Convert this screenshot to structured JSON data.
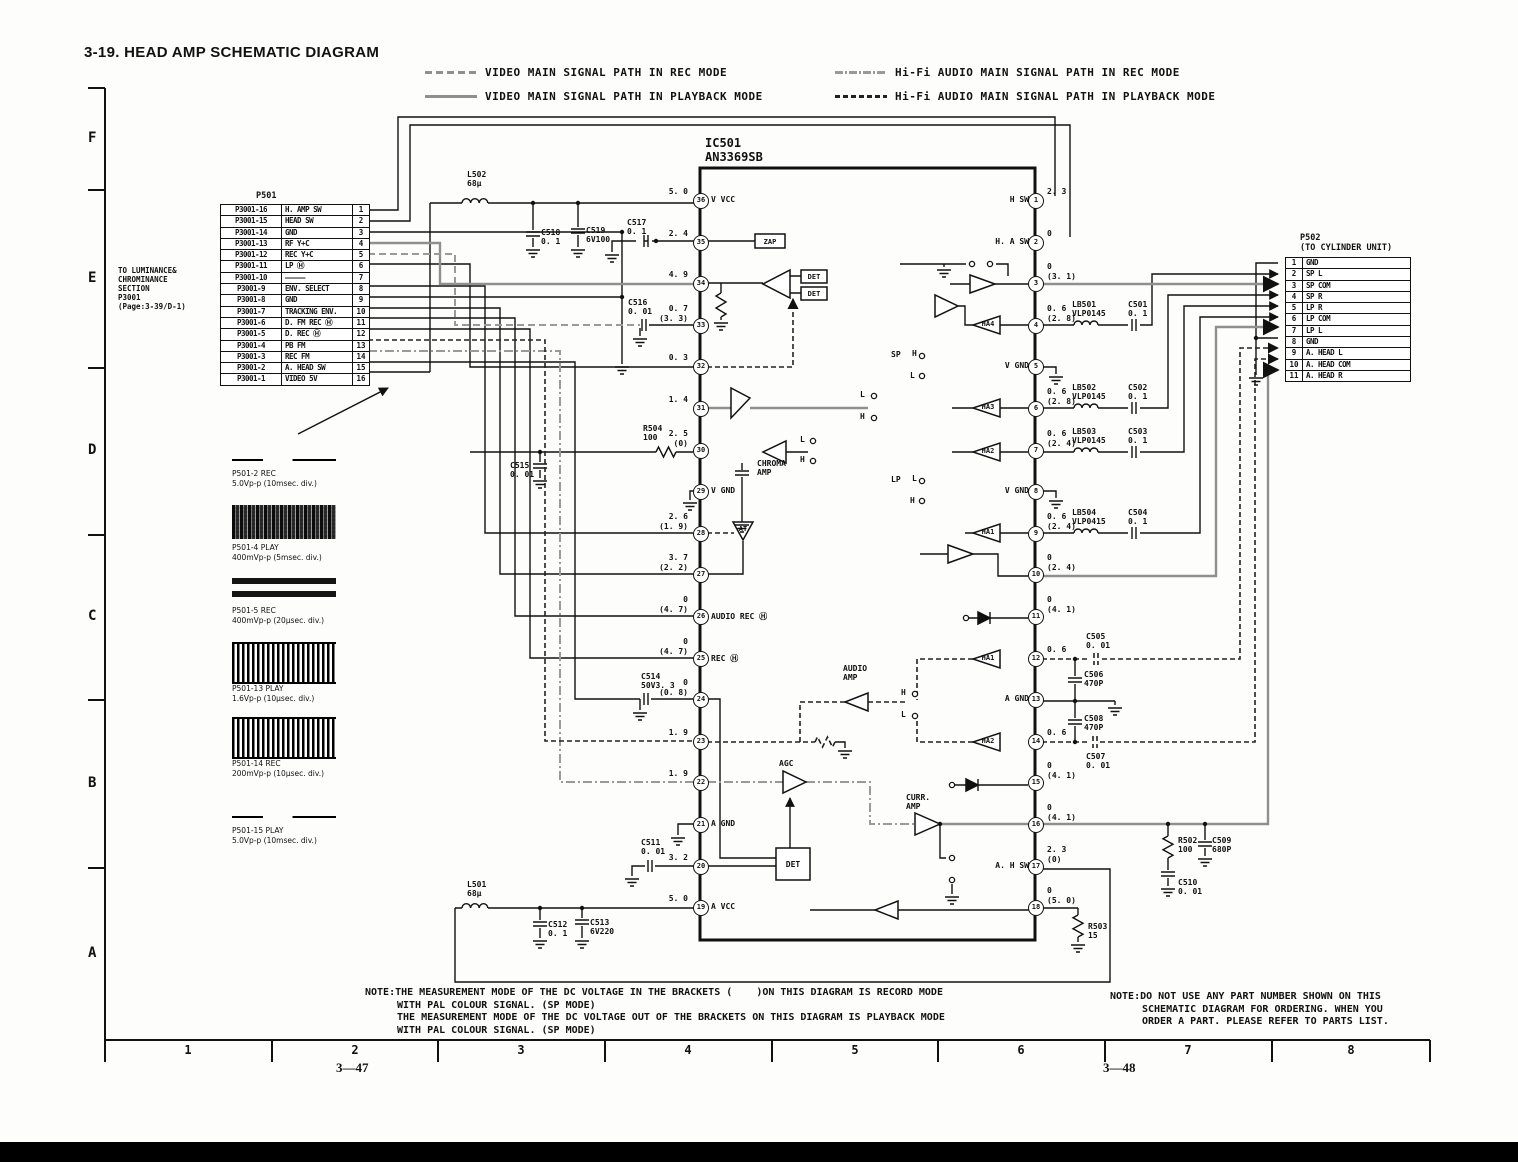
{
  "page": {
    "title": "3-19.  HEAD AMP SCHEMATIC DIAGRAM",
    "page_left": "3—47",
    "page_right": "3—48"
  },
  "colors": {
    "ink": "#111111",
    "gray_path": "#8f8f8f",
    "background": "#fdfdfb"
  },
  "legend": [
    {
      "label": "VIDEO MAIN SIGNAL PATH IN REC MODE",
      "style": "video-rec"
    },
    {
      "label": "VIDEO MAIN SIGNAL PATH IN PLAYBACK MODE",
      "style": "video-play"
    },
    {
      "label": "Hi-Fi AUDIO MAIN SIGNAL PATH IN REC MODE",
      "style": "hifi-rec"
    },
    {
      "label": "Hi-Fi AUDIO MAIN SIGNAL PATH IN PLAYBACK MODE",
      "style": "hifi-play"
    }
  ],
  "grid": {
    "rows": [
      "F",
      "E",
      "D",
      "C",
      "B",
      "A"
    ],
    "cols": [
      "1",
      "2",
      "3",
      "4",
      "5",
      "6",
      "7",
      "8"
    ]
  },
  "p501": {
    "title": "P501",
    "note": "TO LUMINANCE&\nCHROMINANCE\nSECTION\nP3001\n(Page:3-39/D-1)",
    "rows": [
      {
        "ref": "P3001-16",
        "signal": "H. AMP SW",
        "pin": "1"
      },
      {
        "ref": "P3001-15",
        "signal": "HEAD SW",
        "pin": "2"
      },
      {
        "ref": "P3001-14",
        "signal": "GND",
        "pin": "3"
      },
      {
        "ref": "P3001-13",
        "signal": "RF Y+C",
        "pin": "4"
      },
      {
        "ref": "P3001-12",
        "signal": "REC Y+C",
        "pin": "5"
      },
      {
        "ref": "P3001-11",
        "signal": "LP Ⓗ",
        "pin": "6"
      },
      {
        "ref": "P3001-10",
        "signal": "—————",
        "pin": "7"
      },
      {
        "ref": "P3001-9",
        "signal": "ENV. SELECT",
        "pin": "8"
      },
      {
        "ref": "P3001-8",
        "signal": "GND",
        "pin": "9"
      },
      {
        "ref": "P3001-7",
        "signal": "TRACKING ENV.",
        "pin": "10"
      },
      {
        "ref": "P3001-6",
        "signal": "D. FM REC Ⓗ",
        "pin": "11"
      },
      {
        "ref": "P3001-5",
        "signal": "D. REC Ⓗ",
        "pin": "12"
      },
      {
        "ref": "P3001-4",
        "signal": "PB FM",
        "pin": "13"
      },
      {
        "ref": "P3001-3",
        "signal": "REC FM",
        "pin": "14"
      },
      {
        "ref": "P3001-2",
        "signal": "A. HEAD SW",
        "pin": "15"
      },
      {
        "ref": "P3001-1",
        "signal": "VIDEO 5V",
        "pin": "16"
      }
    ]
  },
  "p502": {
    "title": "P502",
    "subtitle": "(TO CYLINDER UNIT)",
    "rows": [
      {
        "pin": "1",
        "signal": "GND"
      },
      {
        "pin": "2",
        "signal": "SP L"
      },
      {
        "pin": "3",
        "signal": "SP COM"
      },
      {
        "pin": "4",
        "signal": "SP R"
      },
      {
        "pin": "5",
        "signal": "LP R"
      },
      {
        "pin": "6",
        "signal": "LP COM"
      },
      {
        "pin": "7",
        "signal": "LP L"
      },
      {
        "pin": "8",
        "signal": "GND"
      },
      {
        "pin": "9",
        "signal": "A. HEAD L"
      },
      {
        "pin": "10",
        "signal": "A. HEAD COM"
      },
      {
        "pin": "11",
        "signal": "A. HEAD R"
      }
    ]
  },
  "ic": {
    "ref": "IC501",
    "part": "AN3369SB",
    "left_pins": [
      {
        "pin": "36",
        "name": "V VCC",
        "v": "5. 0"
      },
      {
        "pin": "35",
        "v": "2. 4"
      },
      {
        "pin": "34",
        "v": "4. 9"
      },
      {
        "pin": "33",
        "v": "0. 7",
        "vb": "(3. 3)"
      },
      {
        "pin": "32",
        "v": "0. 3"
      },
      {
        "pin": "31",
        "v": "1. 4"
      },
      {
        "pin": "30",
        "v": "2. 5",
        "vb": "(0)"
      },
      {
        "pin": "29",
        "name": "V GND"
      },
      {
        "pin": "28",
        "v": "2. 6",
        "vb": "(1. 9)"
      },
      {
        "pin": "27",
        "v": "3. 7",
        "vb": "(2. 2)"
      },
      {
        "pin": "26",
        "name": "AUDIO REC Ⓗ",
        "v": "0",
        "vb": "(4. 7)"
      },
      {
        "pin": "25",
        "name": "REC Ⓗ",
        "v": "0",
        "vb": "(4. 7)"
      },
      {
        "pin": "24",
        "v": "0",
        "vb": "(0. 8)"
      },
      {
        "pin": "23",
        "v": "1. 9"
      },
      {
        "pin": "22",
        "v": "1. 9"
      },
      {
        "pin": "21",
        "name": "A GND"
      },
      {
        "pin": "20",
        "v": "3. 2"
      },
      {
        "pin": "19",
        "name": "A VCC",
        "v": "5. 0"
      }
    ],
    "right_pins": [
      {
        "pin": "1",
        "name": "H SW",
        "v": "2. 3"
      },
      {
        "pin": "2",
        "name": "H. A SW",
        "v": "0"
      },
      {
        "pin": "3",
        "v": "0",
        "vb": "(3. 1)"
      },
      {
        "pin": "4",
        "v": "0. 6",
        "vb": "(2. 8)"
      },
      {
        "pin": "5",
        "name": "V GND"
      },
      {
        "pin": "6",
        "v": "0. 6",
        "vb": "(2. 8)"
      },
      {
        "pin": "7",
        "v": "0. 6",
        "vb": "(2. 4)"
      },
      {
        "pin": "8",
        "name": "V GND"
      },
      {
        "pin": "9",
        "v": "0. 6",
        "vb": "(2. 4)"
      },
      {
        "pin": "10",
        "v": "0",
        "vb": "(2. 4)"
      },
      {
        "pin": "11",
        "v": "0",
        "vb": "(4. 1)"
      },
      {
        "pin": "12",
        "v": "0. 6"
      },
      {
        "pin": "13",
        "name": "A GND"
      },
      {
        "pin": "14",
        "v": "0. 6"
      },
      {
        "pin": "15",
        "v": "0",
        "vb": "(4. 1)"
      },
      {
        "pin": "16",
        "v": "0",
        "vb": "(4. 1)"
      },
      {
        "pin": "17",
        "name": "A. H SW",
        "v": "2. 3",
        "vb": "(0)"
      },
      {
        "pin": "18",
        "v": "0",
        "vb": "(5. 0)"
      }
    ]
  },
  "parts": {
    "l502": {
      "r": "L502",
      "v": "68µ"
    },
    "c518": {
      "r": "C518",
      "v": "0. 1"
    },
    "c519": {
      "r": "C519",
      "v": "6V100"
    },
    "c517": {
      "r": "C517",
      "v": "0. 1"
    },
    "c516": {
      "r": "C516",
      "v": "0. 01"
    },
    "r504": {
      "r": "R504",
      "v": "100"
    },
    "c515": {
      "r": "C515",
      "v": "0. 01"
    },
    "c514": {
      "r": "C514",
      "v": "50V3. 3"
    },
    "c511": {
      "r": "C511",
      "v": "0. 01"
    },
    "l501": {
      "r": "L501",
      "v": "68µ"
    },
    "c512": {
      "r": "C512",
      "v": "0. 1"
    },
    "c513": {
      "r": "C513",
      "v": "6V220"
    },
    "lb501": {
      "r": "LB501",
      "v": "VLP0145"
    },
    "c501": {
      "r": "C501",
      "v": "0. 1"
    },
    "lb502": {
      "r": "LB502",
      "v": "VLP0145"
    },
    "c502": {
      "r": "C502",
      "v": "0. 1"
    },
    "lb503": {
      "r": "LB503",
      "v": "VLP0145"
    },
    "c503": {
      "r": "C503",
      "v": "0. 1"
    },
    "lb504": {
      "r": "LB504",
      "v": "VLP0415"
    },
    "c504": {
      "r": "C504",
      "v": "0. 1"
    },
    "c505": {
      "r": "C505",
      "v": "0. 01"
    },
    "c506": {
      "r": "C506",
      "v": "470P"
    },
    "c508": {
      "r": "C508",
      "v": "470P"
    },
    "c507": {
      "r": "C507",
      "v": "0. 01"
    },
    "r502": {
      "r": "R502",
      "v": "100"
    },
    "c509": {
      "r": "C509",
      "v": "680P"
    },
    "c510": {
      "r": "C510",
      "v": "0. 01"
    },
    "r503": {
      "r": "R503",
      "v": "15"
    }
  },
  "labels": {
    "chroma_amp": "CHROMA\nAMP",
    "audio_amp": "AUDIO\nAMP",
    "agc": "AGC",
    "curr_amp": "CURR.\nAMP",
    "zap": "ZAP",
    "det": "DET",
    "at": "AT",
    "ha1": "HA1",
    "ha2": "HA2",
    "ha3": "HA3",
    "ha4": "HA4",
    "sp": "SP",
    "lp": "LP",
    "h": "H",
    "l": "L"
  },
  "waveforms": [
    {
      "name": "P501-2  REC",
      "spec": "5.0Vp-p (10msec. div.)",
      "kind": "flat"
    },
    {
      "name": "P501-4  PLAY",
      "spec": "400mVp-p (5msec. div.)",
      "kind": "noise"
    },
    {
      "name": "P501-5  REC",
      "spec": "400mVp-p (20µsec. div.)",
      "kind": "bands"
    },
    {
      "name": "P501-13  PLAY",
      "spec": "1.6Vp-p (10µsec. div.)",
      "kind": "sine"
    },
    {
      "name": "P501-14  REC",
      "spec": "200mVp-p (10µsec. div.)",
      "kind": "sine"
    },
    {
      "name": "P501-15  PLAY",
      "spec": "5.0Vp-p (10msec. div.)",
      "kind": "flat"
    }
  ],
  "notes": {
    "left": [
      "NOTE:THE MEASUREMENT MODE OF THE DC VOLTAGE IN THE BRACKETS (    )ON THIS DIAGRAM IS RECORD MODE",
      "WITH PAL COLOUR SIGNAL. (SP MODE)",
      "THE MEASUREMENT MODE OF THE DC VOLTAGE OUT OF THE BRACKETS ON THIS DIAGRAM IS PLAYBACK MODE",
      "WITH PAL COLOUR SIGNAL. (SP MODE)"
    ],
    "right": [
      "NOTE:DO NOT USE ANY PART NUMBER SHOWN ON THIS",
      "SCHEMATIC DIAGRAM FOR ORDERING. WHEN YOU",
      "ORDER A PART. PLEASE REFER TO PARTS LIST."
    ]
  }
}
